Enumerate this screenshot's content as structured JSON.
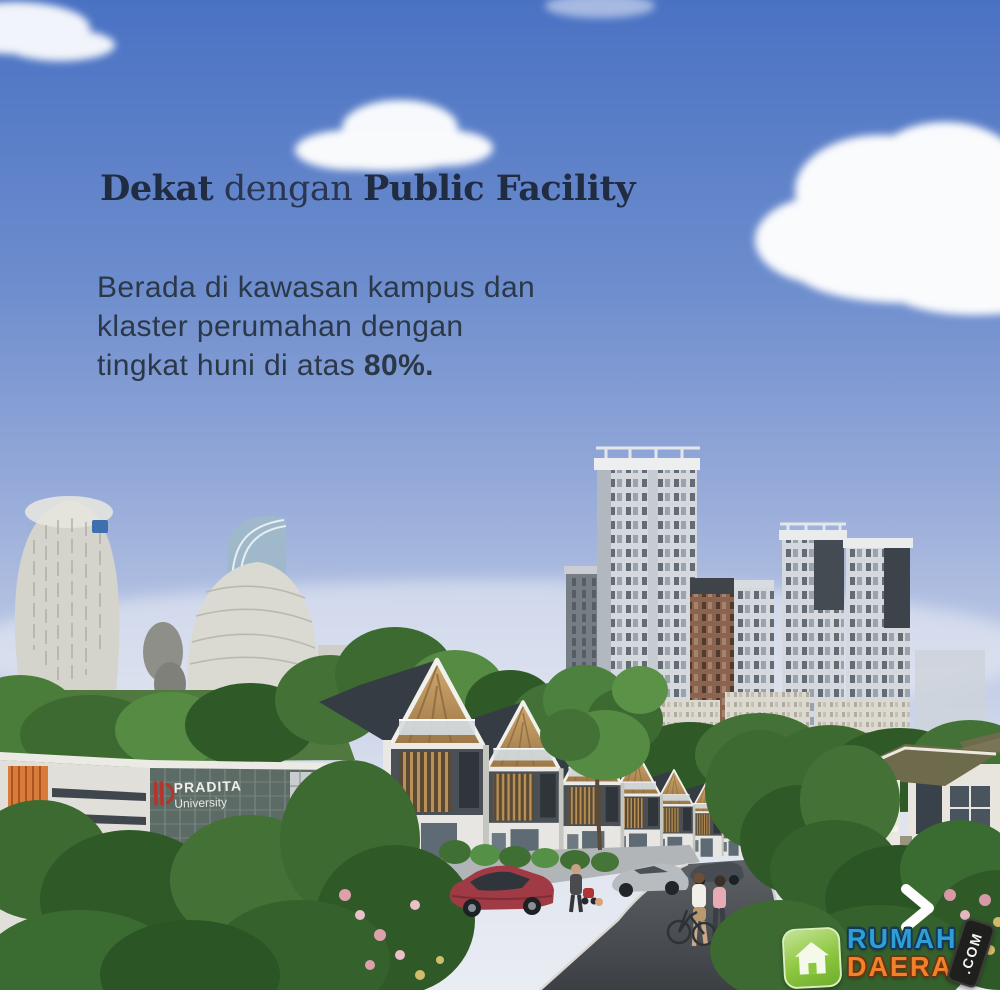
{
  "headline": {
    "bold1": "Dekat",
    "regular": " dengan ",
    "bold2": "Public Facility"
  },
  "body": {
    "line1": "Berada di kawasan kampus dan",
    "line2": "klaster perumahan dengan",
    "line3_prefix": "tingkat huni di atas ",
    "line3_bold": "80%."
  },
  "campus_sign": {
    "title": "PRADITA",
    "subtitle": "University"
  },
  "watermark": {
    "word1": "RUMAH",
    "word2": "DAERAH",
    "tld": ".COM"
  },
  "colors": {
    "sky_top": "#4a72c3",
    "sky_horizon": "#e9ecf3",
    "headline_text": "#202c42",
    "body_text": "#2b3847",
    "brand_blue": "#2e9fd4",
    "brand_orange": "#f0822a",
    "brand_green": "#8dc63f",
    "badge_black": "#1f1f1d",
    "chevron": "#ffffff"
  }
}
